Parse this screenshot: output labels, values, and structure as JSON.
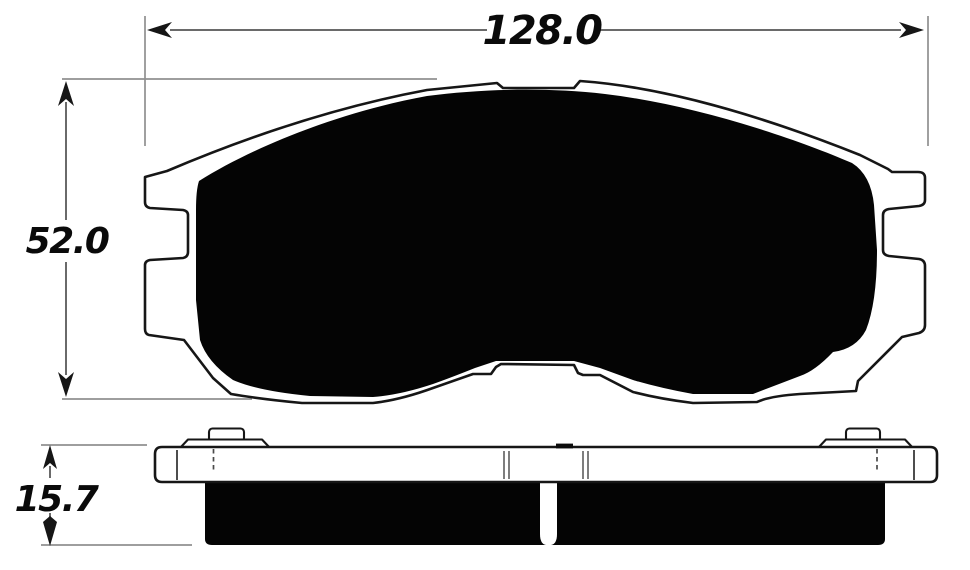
{
  "drawing": {
    "kind": "brake-pad technical drawing, front view and side view",
    "dimensions": {
      "width": "128.0",
      "height": "52.0",
      "thickness": "15.7"
    }
  },
  "colors": {
    "paper": "#ffffff",
    "ink": "#161616",
    "pad": "#040404",
    "dim": "#6a6a6a",
    "ext": "#909090",
    "text": "#0a0a0a"
  }
}
